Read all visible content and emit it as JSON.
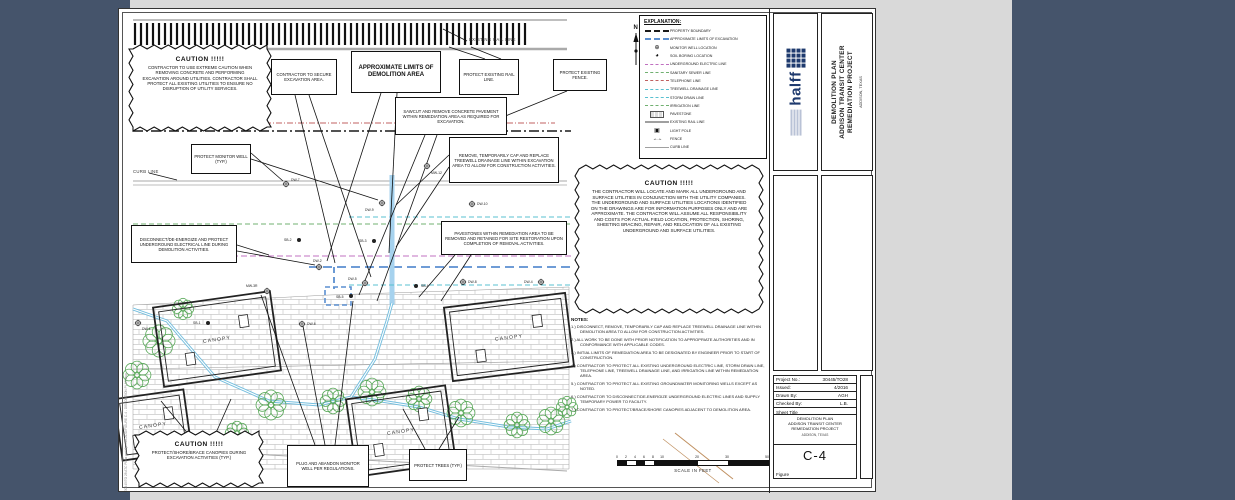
{
  "colors": {
    "outer_bg": "#45546b",
    "scan_bg": "#d9d9d9",
    "sheet": "#ffffff",
    "halff_blue": "#1e3a6e",
    "electric": "#c070c0",
    "sanitary": "#70b070",
    "telephone": "#c06060",
    "treewell": "#58c0d0",
    "irrigation": "#70b070",
    "limits": "#5b8fd0",
    "rail": "#a0a0a0",
    "tree_green": "#58a858"
  },
  "labels": {
    "existing_rail_line": "EXISTING RAIL LINE",
    "curb_line": "CURB LINE",
    "filepath": "30445/TO 28 ATC Plans and Specs/CADD/FIGURE C-4 - DEMOLITION PLAN.dwg",
    "north": "N"
  },
  "cautions": {
    "top_left": {
      "title": "CAUTION  !!!!!",
      "body": "CONTRACTOR TO USE EXTREME CAUTION WHEN REMOVING CONCRETE AND PERFORMING EXCAVATION AROUND UTILITIES. CONTRACTOR SHALL PROTECT ALL EXISTING UTILITIES TO ENSURE NO DISRUPTION OF UTILITY SERVICES."
    },
    "right": {
      "title": "CAUTION  !!!!!",
      "body": "THE CONTRACTOR WILL LOCATE AND MARK ALL UNDERGROUND AND SURFACE UTILITIES IN CONJUNCTION WITH THE UTILITY COMPANIES. THE UNDERGROUND AND SURFACE UTILITIES LOCATIONS IDENTIFIED ON THE DRAWINGS ARE FOR INFORMATION PURPOSES ONLY AND ARE APPROXIMATE.  THE CONTRACTOR WILL ASSUME ALL RESPONSIBILITY AND COSTS FOR ACTUAL FIELD LOCATION, PROTECTION, SHORING, SHEETING BRACING, REPAIR, AND RELOCATION OF ALL EXISTING UNDERGROUND AND SURFACE UTILITIES."
    },
    "bottom_left": {
      "title": "CAUTION  !!!!!",
      "body": "PROTECT/SHORE/BRACE CANOPIES DURING EXCAVATION ACTIVITIES (TYP.)"
    }
  },
  "callouts": {
    "secure": "CONTRACTOR TO SECURE EXCAVATION AREA.",
    "approx_limits": "APPROXIMATE LIMITS OF DEMOLITION AREA",
    "protect_rail": "PROTECT EXISTING RAIL LINE.",
    "protect_fence": "PROTECT EXISTING FENCE.",
    "sawcut": "SAWCUT AND REMOVE CONCRETE PAVEMENT WITHIN REMEDIATION AREA AS REQUIRED FOR EXCAVATION.",
    "remove_treewell": "REMOVE, TEMPORARILY CAP AND REPLACE TREEWELL DRAINAGE LINE WITHIN EXCAVATION AREA TO ALLOW FOR CONSTRUCTION ACTIVITIES.",
    "protect_monitor_well": "PROTECT MONITOR WELL (TYP.)",
    "disconnect": "DISCONNECT/DE-ENERGIZE AND PROTECT UNDERGROUND ELECTRICAL LINE DURING DEMOLITION ACTIVITIES.",
    "pavestones": "PAVESTONES WITHIN REMEDIATION AREA TO BE REMOVED AND RETAINED FOR SITE RESTORATION UPON COMPLETION OF REMOVAL ACTIVITIES.",
    "plug_abandon": "PLUG AND ABANDON MONITOR WELL PER REGULATIONS.",
    "protect_trees": "PROTECT TREES (TYP.)"
  },
  "legend": {
    "title": "EXPLANATION:",
    "items": [
      {
        "label": "PROPERTY BOUNDARY",
        "kind": "line",
        "color": "#1a1a1a",
        "style": "dashed",
        "weight": 2.6
      },
      {
        "label": "APPROXIMATE LIMITS OF EXCAVATION",
        "kind": "line",
        "color": "#5b8fd0",
        "style": "dashed",
        "weight": 2.6
      },
      {
        "label": "MONITOR WELL LOCATION",
        "kind": "sym",
        "glyph": "⊕"
      },
      {
        "label": "SOIL BORING LOCATION",
        "kind": "sym",
        "glyph": "◕"
      },
      {
        "label": "UNDERGROUND ELECTRIC LINE",
        "kind": "line",
        "color": "#c070c0",
        "style": "dashed",
        "weight": 1.4
      },
      {
        "label": "SANITARY SEWER LINE",
        "kind": "line",
        "color": "#70b070",
        "style": "dashed",
        "weight": 1.4
      },
      {
        "label": "TELEPHONE LINE",
        "kind": "line",
        "color": "#c06060",
        "style": "dashed",
        "weight": 1.4
      },
      {
        "label": "TREEWELL DRAINAGE LINE",
        "kind": "line",
        "color": "#58c0d0",
        "style": "dashed",
        "weight": 1.4
      },
      {
        "label": "STORM DRAIN LINE",
        "kind": "line",
        "color": "#58c0d0",
        "style": "dashed",
        "weight": 1.4
      },
      {
        "label": "IRRIGATION LINE",
        "kind": "line",
        "color": "#70b070",
        "style": "dashed",
        "weight": 1.4
      },
      {
        "label": "PAVESTONE",
        "kind": "pave"
      },
      {
        "label": "EXISTING RAIL LINE",
        "kind": "line",
        "color": "#a0a0a0",
        "style": "solid",
        "weight": 2.6
      },
      {
        "label": "LIGHT POLE",
        "kind": "sym",
        "glyph": "▣"
      },
      {
        "label": "FENCE",
        "kind": "fence",
        "glyph": "↔"
      },
      {
        "label": "CURB LINE",
        "kind": "line",
        "color": "#a0a0a0",
        "style": "solid",
        "weight": 1.6
      }
    ]
  },
  "notes": {
    "title": "NOTES:",
    "items": [
      "1.)  DISCONNECT, REMOVE, TEMPORARILY CAP AND REPLACE TREEWELL DRAINAGE LINE WITHIN DEMOLITION AREA TO ALLOW FOR CONSTRUCTION ACTIVITIES.",
      "2.)  ALL WORK TO BE DONE WITH PRIOR NOTIFICATION TO APPROPRIATE AUTHORITIES AND IN CONFORMANCE WITH APPLICABLE CODES.",
      "3.)  INITIAL LIMITS OF REMEDIATION AREA TO BE DESIGNATED BY ENGINEER PRIOR TO START OF CONSTRUCTION.",
      "4.)  CONTRACTOR TO PROTECT ALL EXISTING UNDERGROUND ELECTRIC LINE, STORM DRAIN LINE, TELEPHONE LINE, TREEWELL DRAINAGE LINE, AND IRRIGATION LINE WITHIN REMEDIATION AREA.",
      "5.)  CONTRACTOR TO PROTECT ALL EXISTING GROUNDWATER MONITORING WELLS EXCEPT AS NOTED.",
      "6.)  CONTRACTOR TO DISCONNECT/DE-ENERGIZE UNDERGROUND ELECTRIC LINES AND SUPPLY TEMPORARY POWER TO FACILITY.",
      "7.)  CONTRACTOR TO PROTECT/BRACE/SHORE CANOPIES ADJACENT TO DEMOLITION AREA."
    ]
  },
  "titleblock": {
    "company": "halff",
    "title_line1": "DEMOLITION PLAN",
    "title_line2": "ADDISON TRANSIT CENTER",
    "title_line3": "REMEDIATION PROJECT",
    "location": "ADDISON, TEXAS"
  },
  "project_table": {
    "rows": [
      {
        "label": "Project No.:",
        "value": "30445/TO28"
      },
      {
        "label": "Issued:",
        "value": "4/2016"
      },
      {
        "label": "Drawn By:",
        "value": "AGH"
      },
      {
        "label": "Checked By:",
        "value": "L.B."
      }
    ],
    "sheet_title_label": "Sheet Title",
    "sheet_title_line1": "DEMOLITION PLAN",
    "sheet_title_line2": "ADDISON TRANSIT CENTER",
    "sheet_title_line3": "REMEDIATION PROJECT",
    "location": "ADDISON, TEXAS",
    "figure_number": "C-4",
    "figure_label": "Figure"
  },
  "scale_bar": {
    "numbers": [
      "0",
      "2",
      "4",
      "6",
      "8",
      "10",
      "20",
      "30",
      "50"
    ],
    "label": "SCALE IN FEET"
  },
  "plan": {
    "hatch": {
      "x1": 16,
      "x2": 410,
      "y1": 14,
      "y2": 36,
      "step": 6
    },
    "lines": [
      {
        "pts": [
          [
            14,
            11
          ],
          [
            448,
            11
          ]
        ],
        "c": "#555555",
        "w": 0.7
      },
      {
        "pts": [
          [
            14,
            40
          ],
          [
            448,
            40
          ]
        ],
        "c": "#aaaaaa",
        "w": 2.4
      },
      {
        "pts": [
          [
            14,
            114
          ],
          [
            436,
            114
          ]
        ],
        "c": "#c06060",
        "w": 0.9,
        "dash": "6 2 1 2"
      },
      {
        "pts": [
          [
            14,
            122
          ],
          [
            452,
            122
          ]
        ],
        "c": "#1a1a1a",
        "w": 1.6,
        "dash": "10 3 2 3"
      },
      {
        "pts": [
          [
            14,
            172
          ],
          [
            448,
            172
          ]
        ],
        "c": "#a8a8a8",
        "w": 1
      },
      {
        "pts": [
          [
            14,
            176
          ],
          [
            448,
            176
          ]
        ],
        "c": "#bdbdbd",
        "w": 1
      },
      {
        "pts": [
          [
            230,
            208
          ],
          [
            452,
            208
          ]
        ],
        "c": "#58c0d0",
        "w": 0.9,
        "dash": "5 3"
      },
      {
        "pts": [
          [
            14,
            215
          ],
          [
            452,
            215
          ]
        ],
        "c": "#70b070",
        "w": 0.9,
        "dash": "5 3"
      },
      {
        "pts": [
          [
            14,
            247
          ],
          [
            452,
            247
          ]
        ],
        "c": "#c070c0",
        "w": 0.9,
        "dash": "6 3"
      },
      {
        "pts": [
          [
            190,
            258
          ],
          [
            452,
            258
          ]
        ],
        "c": "#5b8fd0",
        "w": 1.8,
        "dash": "9 5"
      },
      {
        "pts": [
          [
            215,
            258
          ],
          [
            215,
            280
          ]
        ],
        "c": "#5b8fd0",
        "w": 1.8,
        "dash": "6 4"
      },
      {
        "pts": [
          [
            273,
            166
          ],
          [
            273,
            296
          ]
        ],
        "c": "#a6d2ee",
        "w": 5
      },
      {
        "pts": [
          [
            230,
            276
          ],
          [
            452,
            276
          ]
        ],
        "c": "#58c0d0",
        "w": 0.9,
        "dash": "5 3"
      },
      {
        "pts": [
          [
            14,
            360
          ],
          [
            450,
            352
          ]
        ],
        "c": "#999999",
        "w": 0.6
      },
      {
        "pts": [
          [
            14,
            434
          ],
          [
            150,
            446
          ],
          [
            300,
            454
          ],
          [
            448,
            462
          ]
        ],
        "c": "#aaaaaa",
        "w": 1
      },
      {
        "pts": [
          [
            556,
            424
          ],
          [
            614,
            470
          ]
        ],
        "c": "#c09060",
        "w": 1
      },
      {
        "pts": [
          [
            544,
            430
          ],
          [
            600,
            474
          ]
        ],
        "c": "#c09060",
        "w": 0.7
      }
    ],
    "blue_rect": {
      "x": 206,
      "y": 278,
      "w": 26,
      "h": 18
    },
    "brick": [
      [
        14,
        296
      ],
      [
        210,
        286
      ],
      [
        450,
        278
      ],
      [
        450,
        460
      ],
      [
        14,
        460
      ]
    ],
    "drainage": [
      [
        [
          14,
          300
        ],
        [
          48,
          312
        ],
        [
          96,
          368
        ],
        [
          150,
          392
        ],
        [
          200,
          396
        ],
        [
          232,
          388
        ],
        [
          262,
          392
        ],
        [
          300,
          398
        ],
        [
          340,
          410
        ],
        [
          390,
          418
        ],
        [
          428,
          420
        ],
        [
          452,
          412
        ]
      ],
      [
        [
          232,
          388
        ],
        [
          256,
          350
        ],
        [
          268,
          312
        ],
        [
          273,
          294
        ]
      ]
    ],
    "trees": [
      [
        40,
        332,
        15
      ],
      [
        18,
        366,
        13
      ],
      [
        152,
        396,
        14
      ],
      [
        214,
        392,
        12
      ],
      [
        253,
        383,
        13
      ],
      [
        300,
        390,
        12
      ],
      [
        342,
        404,
        13
      ],
      [
        398,
        416,
        12
      ],
      [
        432,
        412,
        13
      ],
      [
        118,
        424,
        11
      ],
      [
        448,
        398,
        10
      ],
      [
        64,
        300,
        10
      ]
    ],
    "canopies": [
      {
        "cx": 98,
        "cy": 330,
        "w": 118,
        "h": 80,
        "rot": -8,
        "label": "CANOPY"
      },
      {
        "cx": 390,
        "cy": 328,
        "w": 122,
        "h": 74,
        "rot": -7,
        "label": "CANOPY"
      },
      {
        "cx": 282,
        "cy": 422,
        "w": 100,
        "h": 78,
        "rot": -8,
        "label": "CANOPY"
      },
      {
        "cx": 34,
        "cy": 416,
        "w": 70,
        "h": 62,
        "rot": -8,
        "label": "CANOPY"
      }
    ],
    "wells": [
      {
        "id": "MW-12",
        "t": "mw",
        "x": 308,
        "y": 157,
        "dx": 4,
        "dy": 8
      },
      {
        "id": "DW-7",
        "t": "mw",
        "x": 167,
        "y": 175,
        "dx": 5,
        "dy": -3
      },
      {
        "id": "DW-9",
        "t": "mw",
        "x": 263,
        "y": 194,
        "dx": -17,
        "dy": 8
      },
      {
        "id": "DW-10",
        "t": "mw",
        "x": 353,
        "y": 195,
        "dx": 5,
        "dy": 1
      },
      {
        "id": "SB-2",
        "t": "sb",
        "x": 180,
        "y": 231,
        "dx": -15,
        "dy": 1
      },
      {
        "id": "SB-3",
        "t": "sb",
        "x": 255,
        "y": 232,
        "dx": -15,
        "dy": 1
      },
      {
        "id": "DW-2",
        "t": "mw",
        "x": 200,
        "y": 258,
        "dx": -6,
        "dy": -5
      },
      {
        "id": "MW-3R",
        "t": "mw",
        "x": 148,
        "y": 282,
        "dx": -21,
        "dy": -4
      },
      {
        "id": "DW-5",
        "t": "mw",
        "x": 246,
        "y": 274,
        "dx": -17,
        "dy": -3
      },
      {
        "id": "SB-5",
        "t": "sb",
        "x": 232,
        "y": 287,
        "dx": -15,
        "dy": 2
      },
      {
        "id": "SB-4",
        "t": "sb",
        "x": 297,
        "y": 277,
        "dx": 5,
        "dy": 1
      },
      {
        "id": "DW-8",
        "t": "mw",
        "x": 344,
        "y": 273,
        "dx": 5,
        "dy": 1
      },
      {
        "id": "DW-4",
        "t": "mw",
        "x": 422,
        "y": 273,
        "dx": -17,
        "dy": 1
      },
      {
        "id": "SB-1",
        "t": "sb",
        "x": 89,
        "y": 314,
        "dx": -15,
        "dy": 1
      },
      {
        "id": "DW-1",
        "t": "mw",
        "x": 19,
        "y": 314,
        "dx": 4,
        "dy": 7
      },
      {
        "id": "DW-6",
        "t": "mw",
        "x": 183,
        "y": 315,
        "dx": 5,
        "dy": 1
      }
    ],
    "leaders": [
      [
        176,
        86,
        216,
        254
      ],
      [
        190,
        86,
        252,
        268
      ],
      [
        262,
        84,
        208,
        252
      ],
      [
        278,
        84,
        270,
        244
      ],
      [
        366,
        50,
        330,
        38
      ],
      [
        382,
        50,
        352,
        38
      ],
      [
        448,
        82,
        352,
        121
      ],
      [
        306,
        126,
        240,
        286
      ],
      [
        318,
        126,
        258,
        292
      ],
      [
        330,
        146,
        277,
        196
      ],
      [
        330,
        158,
        277,
        238
      ],
      [
        132,
        144,
        164,
        172
      ],
      [
        132,
        150,
        259,
        191
      ],
      [
        118,
        236,
        150,
        246
      ],
      [
        118,
        242,
        196,
        256
      ],
      [
        336,
        246,
        300,
        288
      ],
      [
        352,
        246,
        322,
        292
      ],
      [
        196,
        436,
        142,
        286
      ],
      [
        206,
        436,
        184,
        317
      ],
      [
        216,
        436,
        234,
        292
      ],
      [
        306,
        440,
        284,
        400
      ],
      [
        320,
        440,
        340,
        408
      ],
      [
        70,
        426,
        42,
        392
      ],
      [
        96,
        426,
        112,
        390
      ],
      [
        30,
        164,
        58,
        171
      ],
      [
        348,
        32,
        324,
        20
      ]
    ],
    "north": {
      "x": 517,
      "y": 16
    }
  }
}
